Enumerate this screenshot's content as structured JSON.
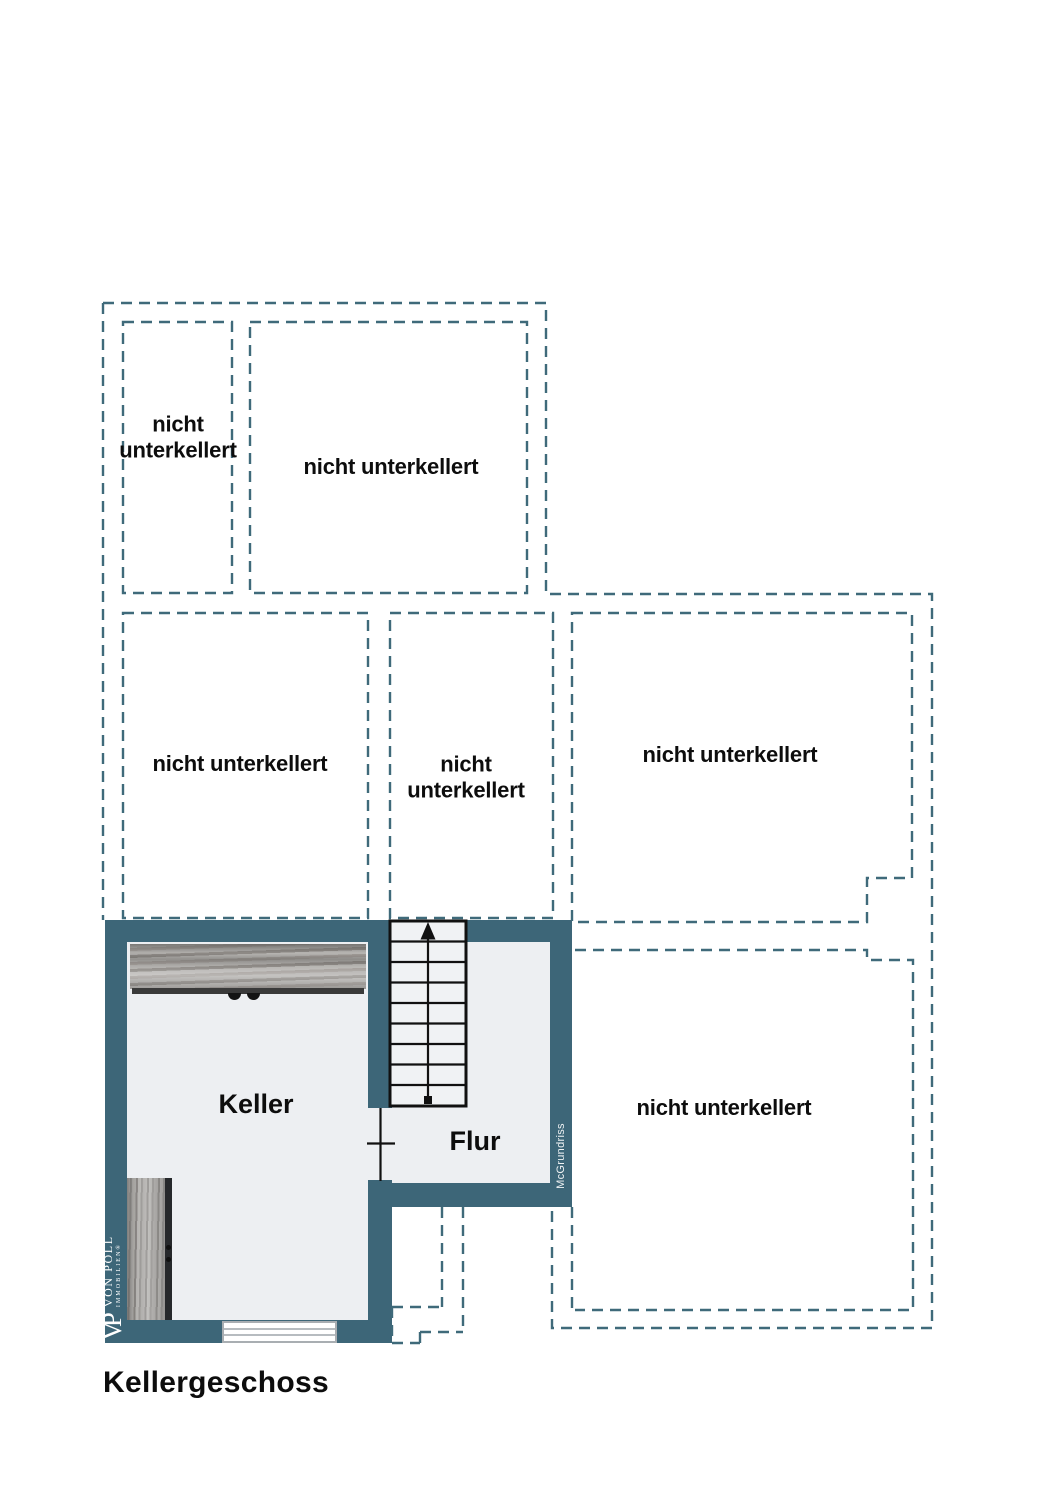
{
  "title": {
    "text": "Kellergeschoss"
  },
  "watermark": {
    "text": "McGrundriss"
  },
  "logo": {
    "monogram": "VP",
    "name": "VON POLL",
    "subtitle": "IMMOBILIEN®"
  },
  "rooms": [
    {
      "id": "keller",
      "label": "Keller"
    },
    {
      "id": "flur",
      "label": "Flur"
    }
  ],
  "areas": [
    {
      "id": "top-left",
      "label": "nicht unterkellert"
    },
    {
      "id": "top-right",
      "label": "nicht unterkellert"
    },
    {
      "id": "mid-left",
      "label": "nicht unterkellert"
    },
    {
      "id": "mid-center",
      "label": "nicht unterkellert"
    },
    {
      "id": "mid-right",
      "label": "nicht unterkellert"
    },
    {
      "id": "bottom-right",
      "label": "nicht unterkellert"
    }
  ],
  "colors": {
    "wall": "#3d6678",
    "dashed_outline": "#3f6a7a",
    "interior": "#edeff2",
    "stair_fill": "#f0f2f4",
    "plan_line": "#111111",
    "wood_light": "#b8b6b3",
    "wood_dark": "#8f8b87",
    "window_frame": "#a9aeb2",
    "label_text": "#0d0d0d",
    "logo_text": "#ffffff"
  }
}
